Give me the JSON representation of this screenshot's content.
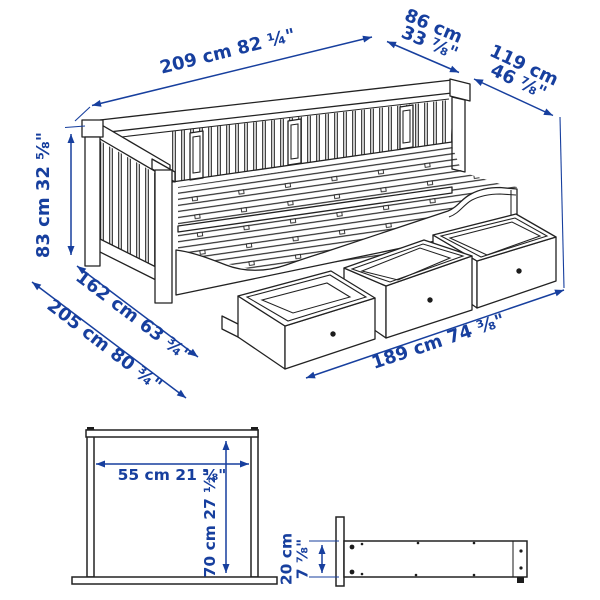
{
  "colors": {
    "dimension_blue": "#173f9e",
    "line_dark": "#222222",
    "knob_dark": "#1c1c1c",
    "background": "#ffffff"
  },
  "daybed_view": {
    "length_top": "209 cm 82 ¼\"",
    "depth_folded_l1": "86 cm",
    "depth_folded_l2": "33 ⅞\"",
    "depth_extended_l1": "119 cm",
    "depth_extended_l2": "46 ⅞\"",
    "height": "83 cm 32 ⅝\"",
    "depth_floor_inner": "162 cm 63 ¾\"",
    "depth_floor_outer": "205 cm 80 ¾\"",
    "length_front": "189 cm 74 ⅜\""
  },
  "clearance_view": {
    "width": "55 cm 21 ⅝\"",
    "height": "70 cm 27 ½\""
  },
  "rail_view": {
    "height_l1": "20 cm",
    "height_l2": "7 ⅞\""
  }
}
